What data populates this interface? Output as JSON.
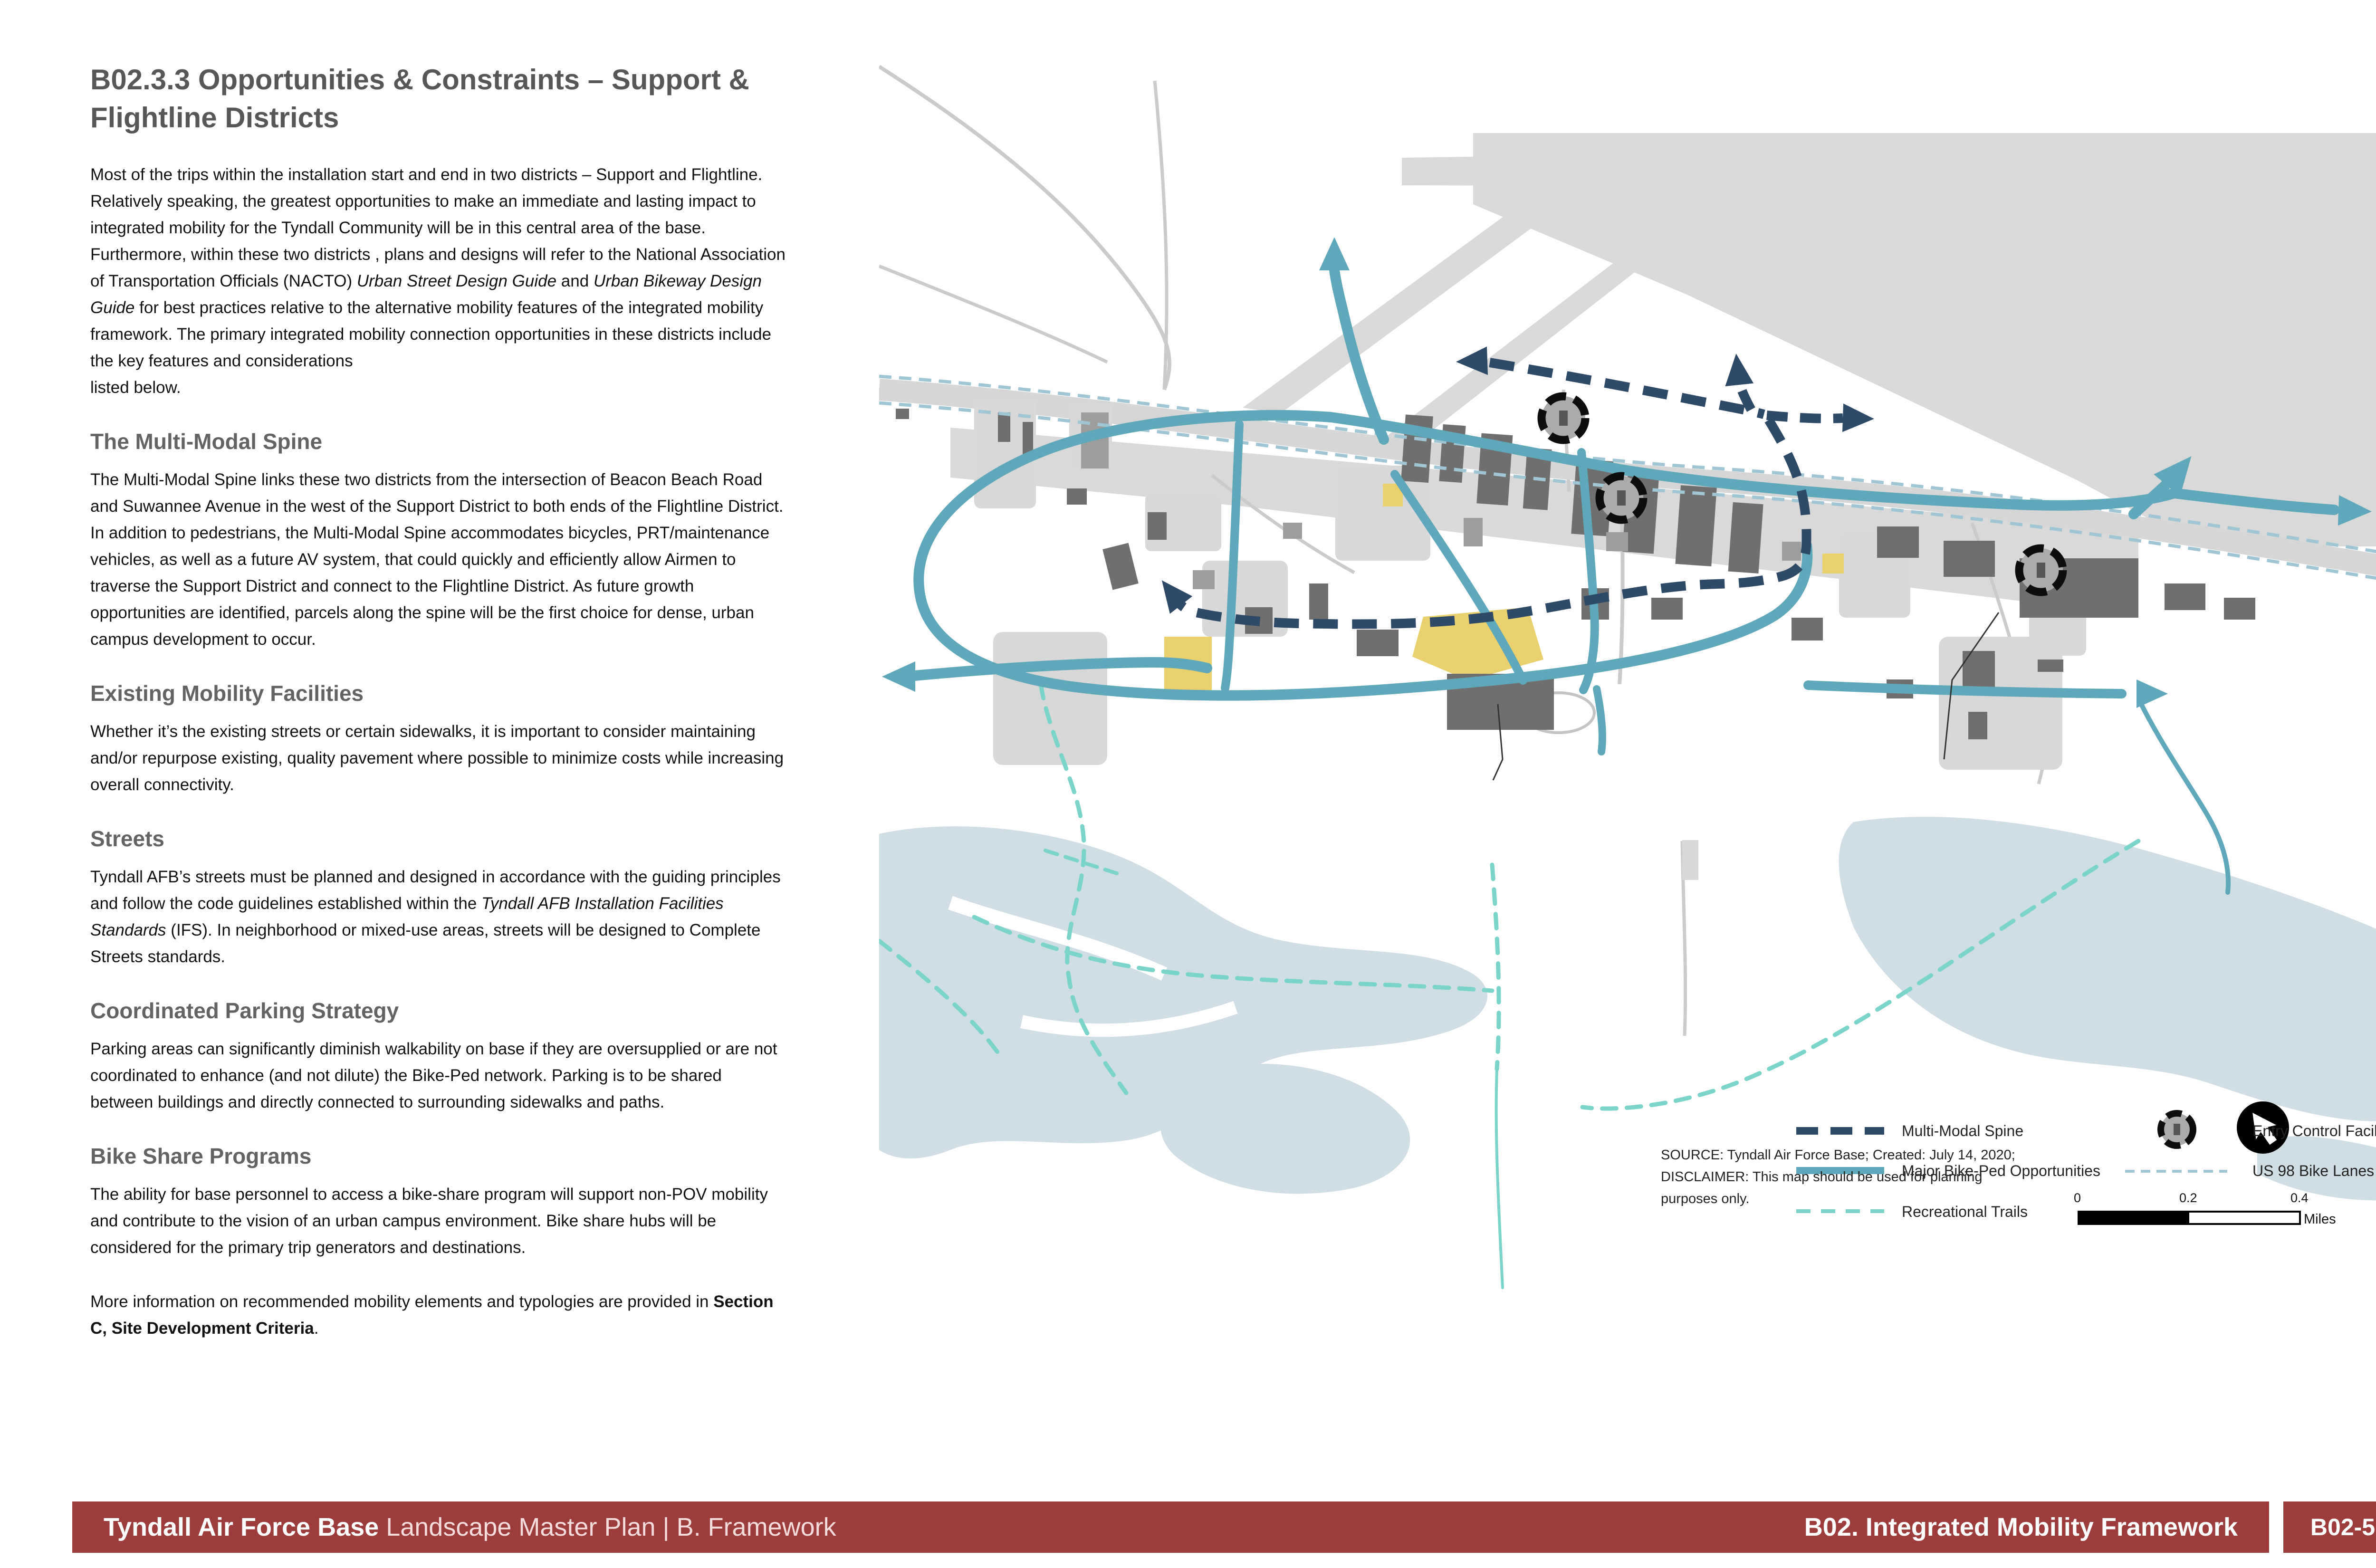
{
  "article": {
    "title": "B02.3.3 Opportunities & Constraints – Support & Flightline Districts",
    "intro_html": "Most of the trips within the installation start and end in two districts – Support and Flightline. Relatively speaking, the greatest opportunities to make an immediate and lasting impact to integrated mobility for the Tyndall Community will be in this central area of the base. Furthermore, within these two districts , plans and designs will refer to the National Association of Transportation Officials (NACTO) <i>Urban Street Design Guide</i> and <i>Urban Bikeway Design Guide</i> for best practices relative to the alternative mobility features of the integrated mobility framework. The primary integrated mobility connection opportunities in these districts include the key features and considerations<br>listed below.",
    "sections": [
      {
        "heading": "The Multi-Modal Spine",
        "body_html": "The Multi-Modal Spine links these two districts from the intersection of Beacon Beach Road and Suwannee Avenue in the west of the Support District to both ends of the Flightline District. In addition to pedestrians, the Multi-Modal Spine accommodates bicycles, PRT/maintenance vehicles, as well as a future AV system, that could quickly and efficiently allow Airmen to traverse the Support District and connect to the Flightline District. As future growth opportunities are identified, parcels along the spine will be the first choice for dense, urban campus development to occur."
      },
      {
        "heading": "Existing Mobility Facilities",
        "body_html": "Whether it’s the existing streets or certain sidewalks, it is important to consider maintaining and/or repurpose existing, quality pavement where possible to minimize costs while increasing overall connectivity."
      },
      {
        "heading": "Streets",
        "body_html": "Tyndall AFB’s streets must be planned and designed in accordance with the guiding principles and follow the code guidelines established within the <i>Tyndall AFB Installation Facilities Standards</i> (IFS). In neighborhood or mixed-use areas, streets will be designed to Complete Streets standards."
      },
      {
        "heading": "Coordinated Parking Strategy",
        "body_html": "Parking areas can significantly diminish walkability on base if they are oversupplied or are not coordinated to enhance (and not dilute) the Bike-Ped network. Parking is to be shared between buildings and directly connected to surrounding sidewalks and paths."
      },
      {
        "heading": "Bike Share Programs",
        "body_html": "The ability for base personnel to access a bike-share program will support non-POV mobility and contribute to the vision of an urban campus environment. Bike share hubs will be considered for the primary trip generators and destinations."
      }
    ],
    "closing_html": "More information on recommended mobility elements and typologies are provided in <b>Section C, Site Development Criteria</b>."
  },
  "map": {
    "legend": {
      "multi_modal_spine": "Multi-Modal Spine",
      "major_bike_ped": "Major Bike-Ped Opportunities",
      "recreational_trails": "Recreational Trails",
      "entry_control_facility": "Entry Control Facility",
      "us98_bike_lanes": "US 98  Bike Lanes"
    },
    "source_lines": [
      "SOURCE: Tyndall Air Force Base; Created: July 14, 2020;",
      "DISCLAIMER: This map should be used for planning",
      "purposes only."
    ],
    "scale": {
      "t0": "0",
      "t1": "0.2",
      "t2": "0.4",
      "unit": "Miles"
    },
    "icons": {
      "north_arrow": "north-arrow",
      "entry_control": "entry-control-facility-icon"
    },
    "colors": {
      "major_bike_ped_teal": "#5FA7BA",
      "multi_modal_navy": "#2E4A69",
      "recreational_mint": "#7BD4C9",
      "us98_lane_blue": "#9FC6D4",
      "water": "#CFDDE4",
      "airfield_gray": "#D9D9D9",
      "parcel_yellow": "#EAD16E",
      "footer_maroon": "#9C3D3B"
    }
  },
  "footer": {
    "left_bold": "Tyndall Air Force Base",
    "left_rest": " Landscape Master Plan | B. Framework",
    "right_title": "B02. Integrated Mobility Framework",
    "page_number": "B02-5"
  }
}
